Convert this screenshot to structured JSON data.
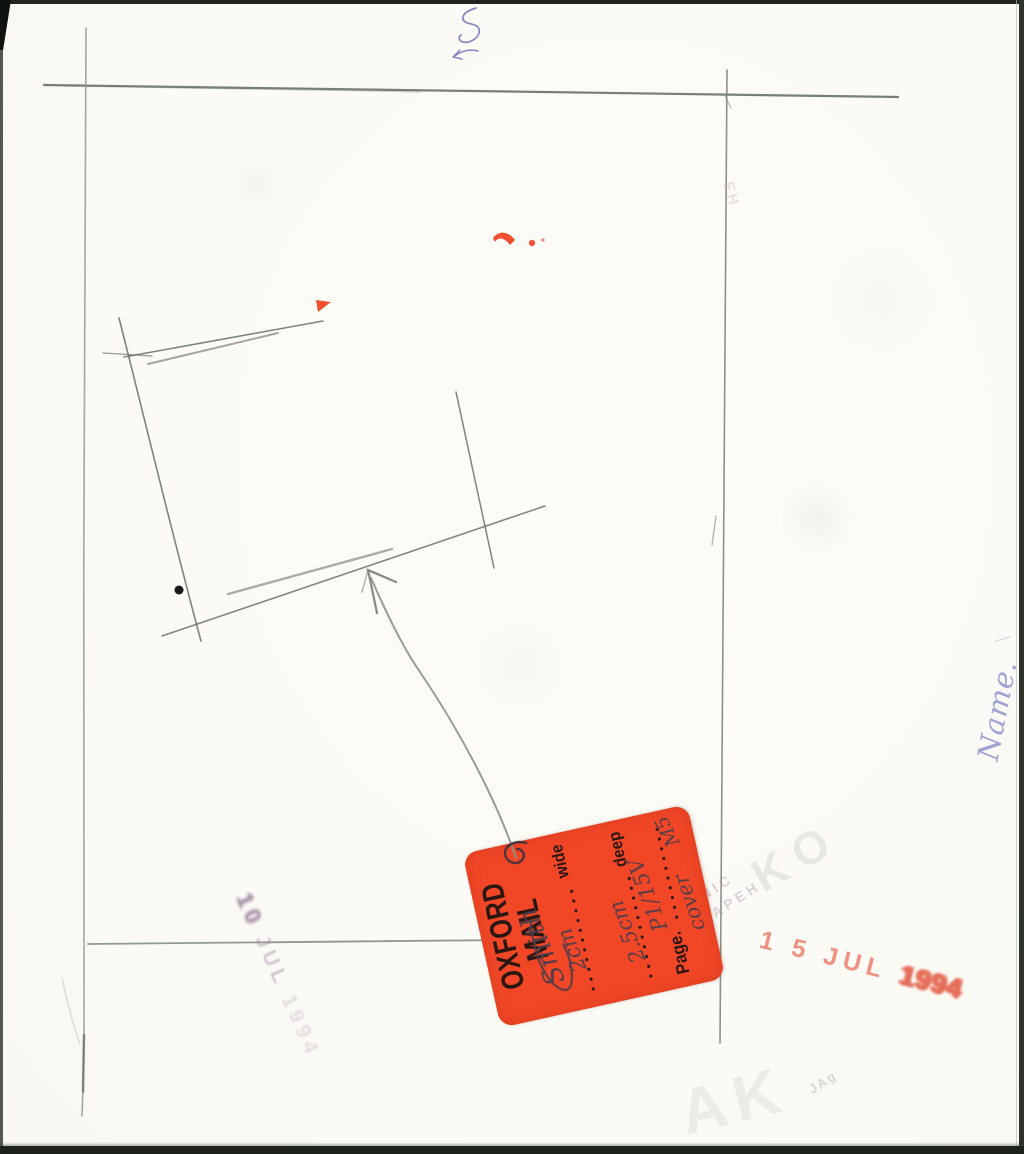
{
  "page": {
    "background": "#fbfaf5",
    "edge_color": "#20261f",
    "pencil_color": "#6b726b"
  },
  "sticker": {
    "bg_color": "#f14727",
    "print_color": "#2a1711",
    "ink_color": "#4b3d49",
    "brand_line1": "OXFORD",
    "brand_line2": "MAIL",
    "wide_label": "wide",
    "deep_label": "deep",
    "page_label": "Page.",
    "hw_name": "Smith",
    "hw_wide": "2cm",
    "hw_deep": "2.5cm",
    "hw_page": "P1/15V",
    "hw_note": "cover",
    "hw_code": "M5"
  },
  "stamps": {
    "red_color": "#ef9180",
    "red_date": "1 5 JUL",
    "red_year": "1994",
    "purple_color": "#a78fad",
    "purple_day": "10",
    "purple_month": "JUL",
    "purple_year": "1994",
    "name_ink": "#9298cf",
    "name_label": "Name."
  },
  "ghost_marks": {
    "large_letters": "KO",
    "line1": "NIC",
    "line2": "APEH",
    "bottom_letters": "AK",
    "small_text": "JAg",
    "top_right": "FH"
  }
}
